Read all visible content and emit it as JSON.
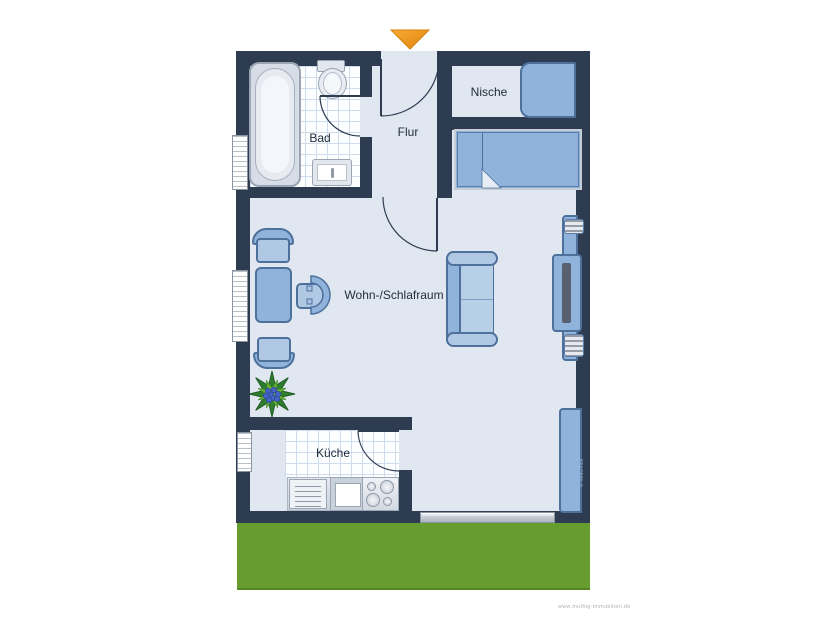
{
  "floorplan": {
    "rooms": [
      {
        "name": "bad",
        "label": "Bad"
      },
      {
        "name": "flur",
        "label": "Flur"
      },
      {
        "name": "nische",
        "label": "Nische"
      },
      {
        "name": "wohn-schlafraum",
        "label": "Wohn-/Schlafraum"
      },
      {
        "name": "kueche",
        "label": "Küche"
      }
    ],
    "entrance_marker": "orange-arrow-down",
    "furniture": [
      "bathtub",
      "toilet",
      "washbasin",
      "wardrobe",
      "single-bed",
      "sofa",
      "tv-lowboard",
      "speaker-top",
      "speaker-bottom",
      "sideboard",
      "dining-table",
      "chair-top",
      "chair-bottom",
      "armchair",
      "plant",
      "kitchen-unit",
      "kitchen-sink",
      "stove"
    ],
    "window_count": "3",
    "door_count": "4",
    "watermarks": {
      "site_url": "www.muthig-immobilien.de",
      "copyright_vertical": "© hedOffice"
    },
    "colors": {
      "wall": "#2d3c51",
      "floor": "#e1e7f0",
      "tile_line": "#cfdcec",
      "furniture_blue": "#8fb3da",
      "furniture_light_blue": "#b0c8e4",
      "furniture_outline": "#4e719c",
      "lawn_green": "#679c2f",
      "arrow_orange": "#f49b20"
    }
  }
}
